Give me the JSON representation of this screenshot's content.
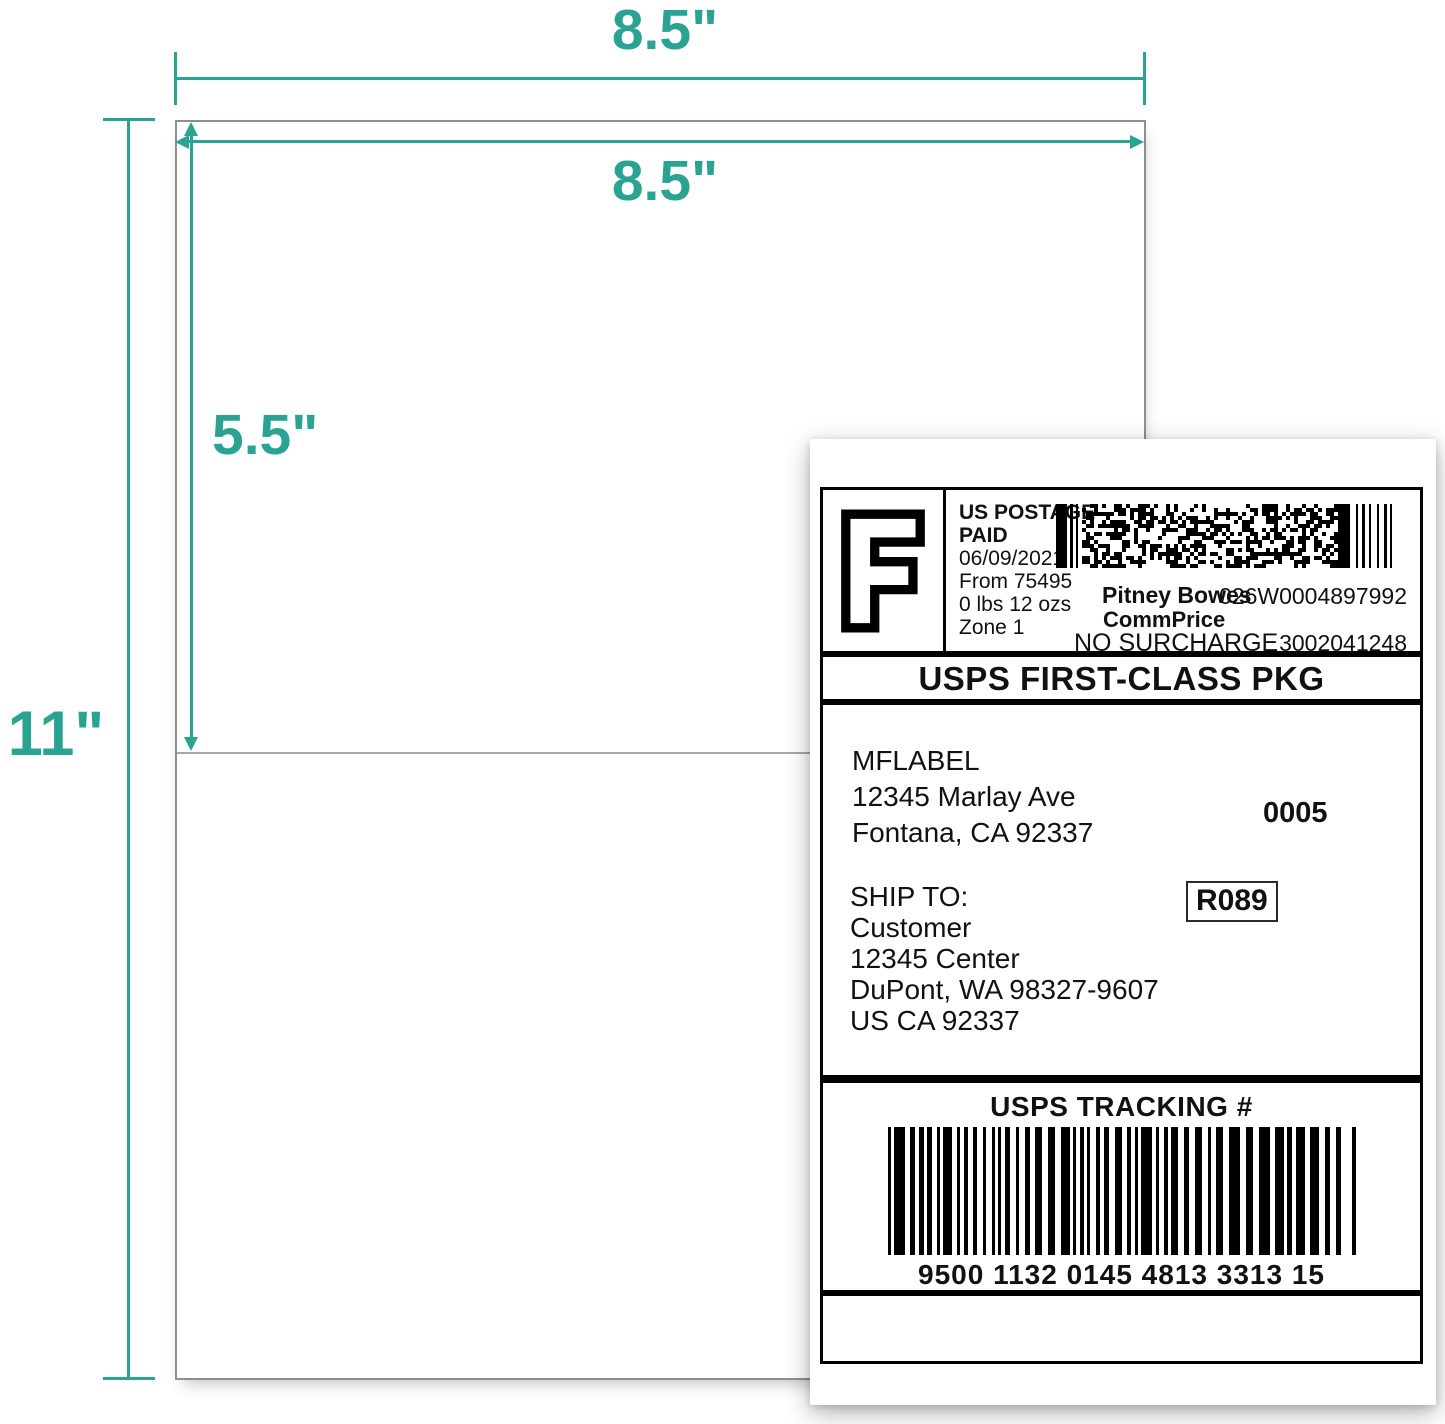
{
  "colors": {
    "accent_teal": "#2aa392",
    "sheet_border": "#8f8f8f",
    "fold_line": "#a8a8a8",
    "label_border": "#000000"
  },
  "dimensions": {
    "sheet_width": "8.5\"",
    "label_width": "8.5\"",
    "label_height": "5.5\"",
    "sheet_height": "11\""
  },
  "shipping_label": {
    "postage": {
      "logo_letter": "F",
      "paid_line": "US POSTAGE PAID",
      "date": "06/09/2021",
      "origin": "From 75495",
      "weight": "0 lbs 12 ozs",
      "zone": "Zone 1",
      "vendor": "Pitney Bowes",
      "rate_name": "CommPrice",
      "surcharge": "NO SURCHARGE",
      "meter_id": "026W0004897992",
      "account_id": "3002041248"
    },
    "service": "USPS FIRST-CLASS PKG",
    "from_address": [
      "MFLABEL",
      "12345 Marlay Ave",
      "Fontana, CA 92337"
    ],
    "batch_number": "0005",
    "ship_to": {
      "heading": "SHIP TO:",
      "lines": [
        "Customer",
        "12345 Center",
        "DuPont, WA 98327-9607",
        "US CA 92337"
      ],
      "route_code": "R089"
    },
    "tracking": {
      "heading": "USPS TRACKING #",
      "number": "9500 1132 0145 4813 3313 15"
    }
  }
}
